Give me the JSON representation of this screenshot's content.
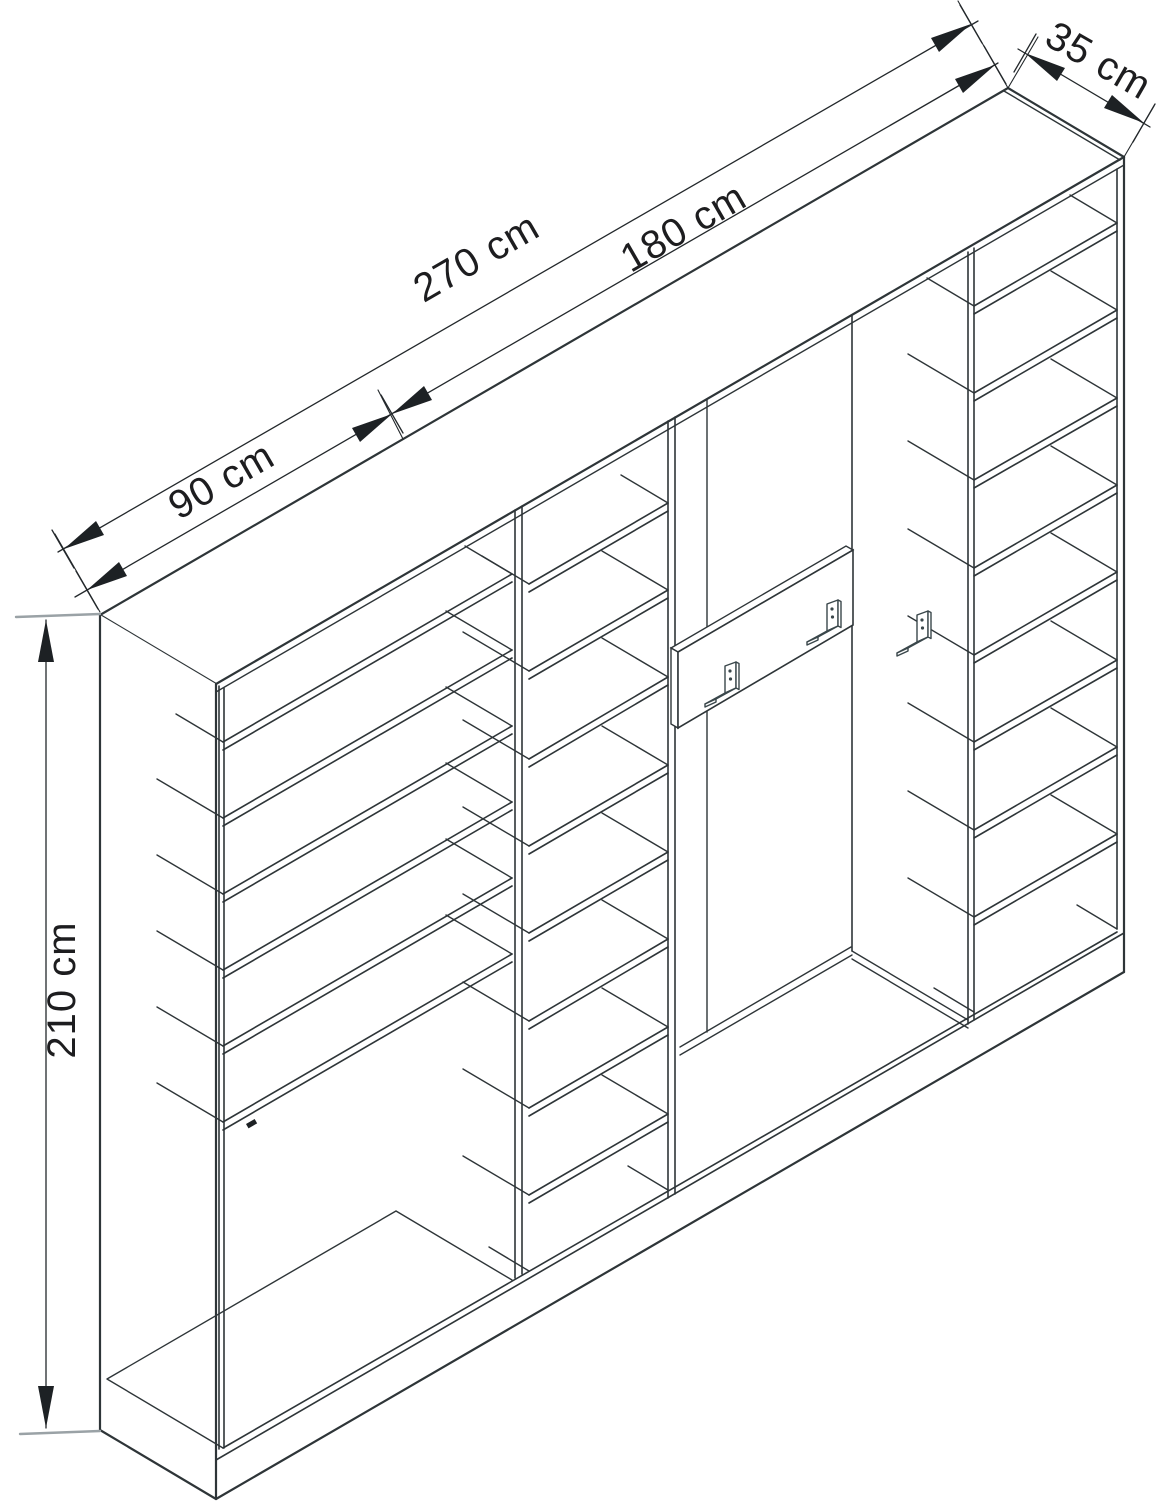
{
  "meta": {
    "drawing_type": "isometric furniture technical drawing",
    "background": "#ffffff",
    "line_color": "#2e3538",
    "label_color": "#1d1d1f"
  },
  "dimensions": {
    "total_width": {
      "label": "270 cm"
    },
    "right_section_width": {
      "label": "180 cm"
    },
    "left_section_width": {
      "label": "90 cm"
    },
    "depth": {
      "label": "35 cm"
    },
    "height": {
      "label": "210 cm"
    }
  },
  "furniture": {
    "description": "hallway wardrobe unit with shoe-shelf cabinet, shelf columns and open coat compartment with hooks",
    "coat_hooks_visible": 3,
    "left_unit_shelves": 6,
    "center_column_shelves": 8,
    "right_column_shelves": 8
  }
}
